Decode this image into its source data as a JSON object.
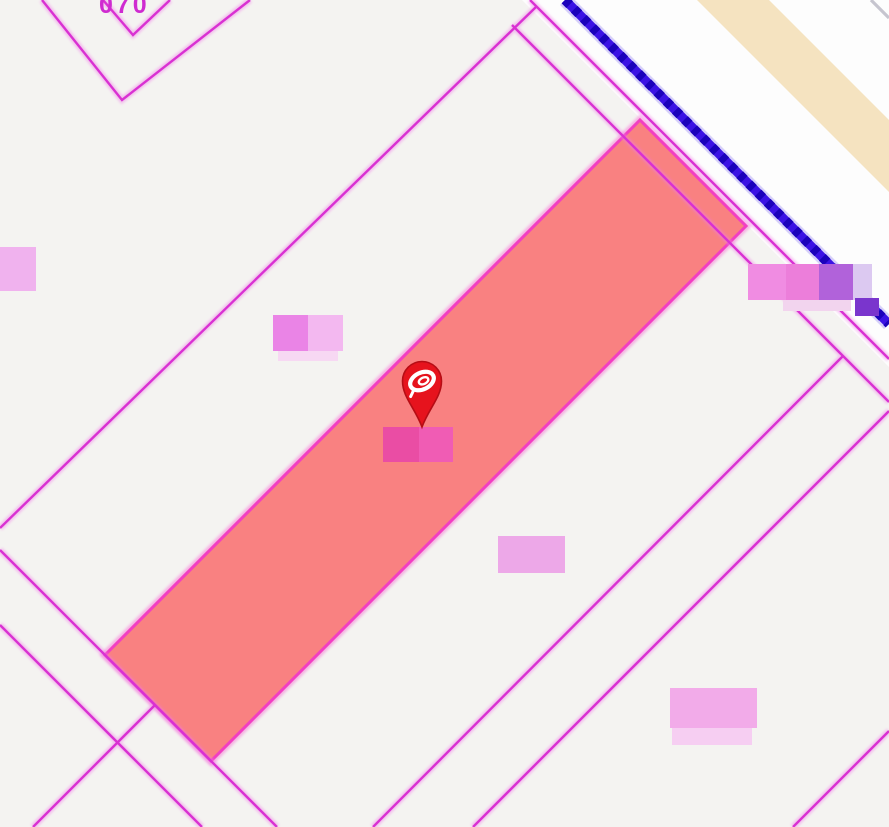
{
  "map": {
    "kind": "cadastral-parcel-map",
    "top_parcel_label_partial": "070",
    "marker": {
      "name": "selected-location-pin"
    },
    "highlighted_parcel": {
      "state": "selected"
    },
    "blurred_labels_count": 6
  },
  "colors": {
    "background": "#f4f3f1",
    "road_fill": "#fdfdfd",
    "road_casing_beige": "#f5e3c0",
    "boundary_magenta": "#d931d2",
    "boundary_glow": "#f07ae8",
    "highlight_fill": "#f98181",
    "highlight_stroke": "#f23ec2",
    "highlight_glow": "#f573d4",
    "blue_line": "#3b13e4",
    "blue_line_dark": "#1b02bb",
    "blue_line_halo": "#9b8cf2",
    "gray_line": "#c6c5cf",
    "label_text_magenta": "#cf2bd0",
    "pin_red": "#e6131d",
    "pin_red_dark": "#b60d15",
    "pin_logo_white": "#ffffff",
    "blur1": "#f0b2ee",
    "blur2_dark": "#ea84e6",
    "blur2_light": "#f3b8f0",
    "blur2_pale": "#f7d8f3",
    "blur3_a": "#ea4da4",
    "blur3_b": "#f05cb4",
    "blur4": "#eda8e8",
    "blur5": "#f2abe9",
    "blur5_pale": "#f6cef2",
    "blur6_a": "#f08ce2",
    "blur6_b": "#ec7eda",
    "blur6_c": "#b162da",
    "blur6_d": "#dcc9f1",
    "blur6_e": "#7a35cd",
    "blur6_pale": "#f2d4ee"
  }
}
